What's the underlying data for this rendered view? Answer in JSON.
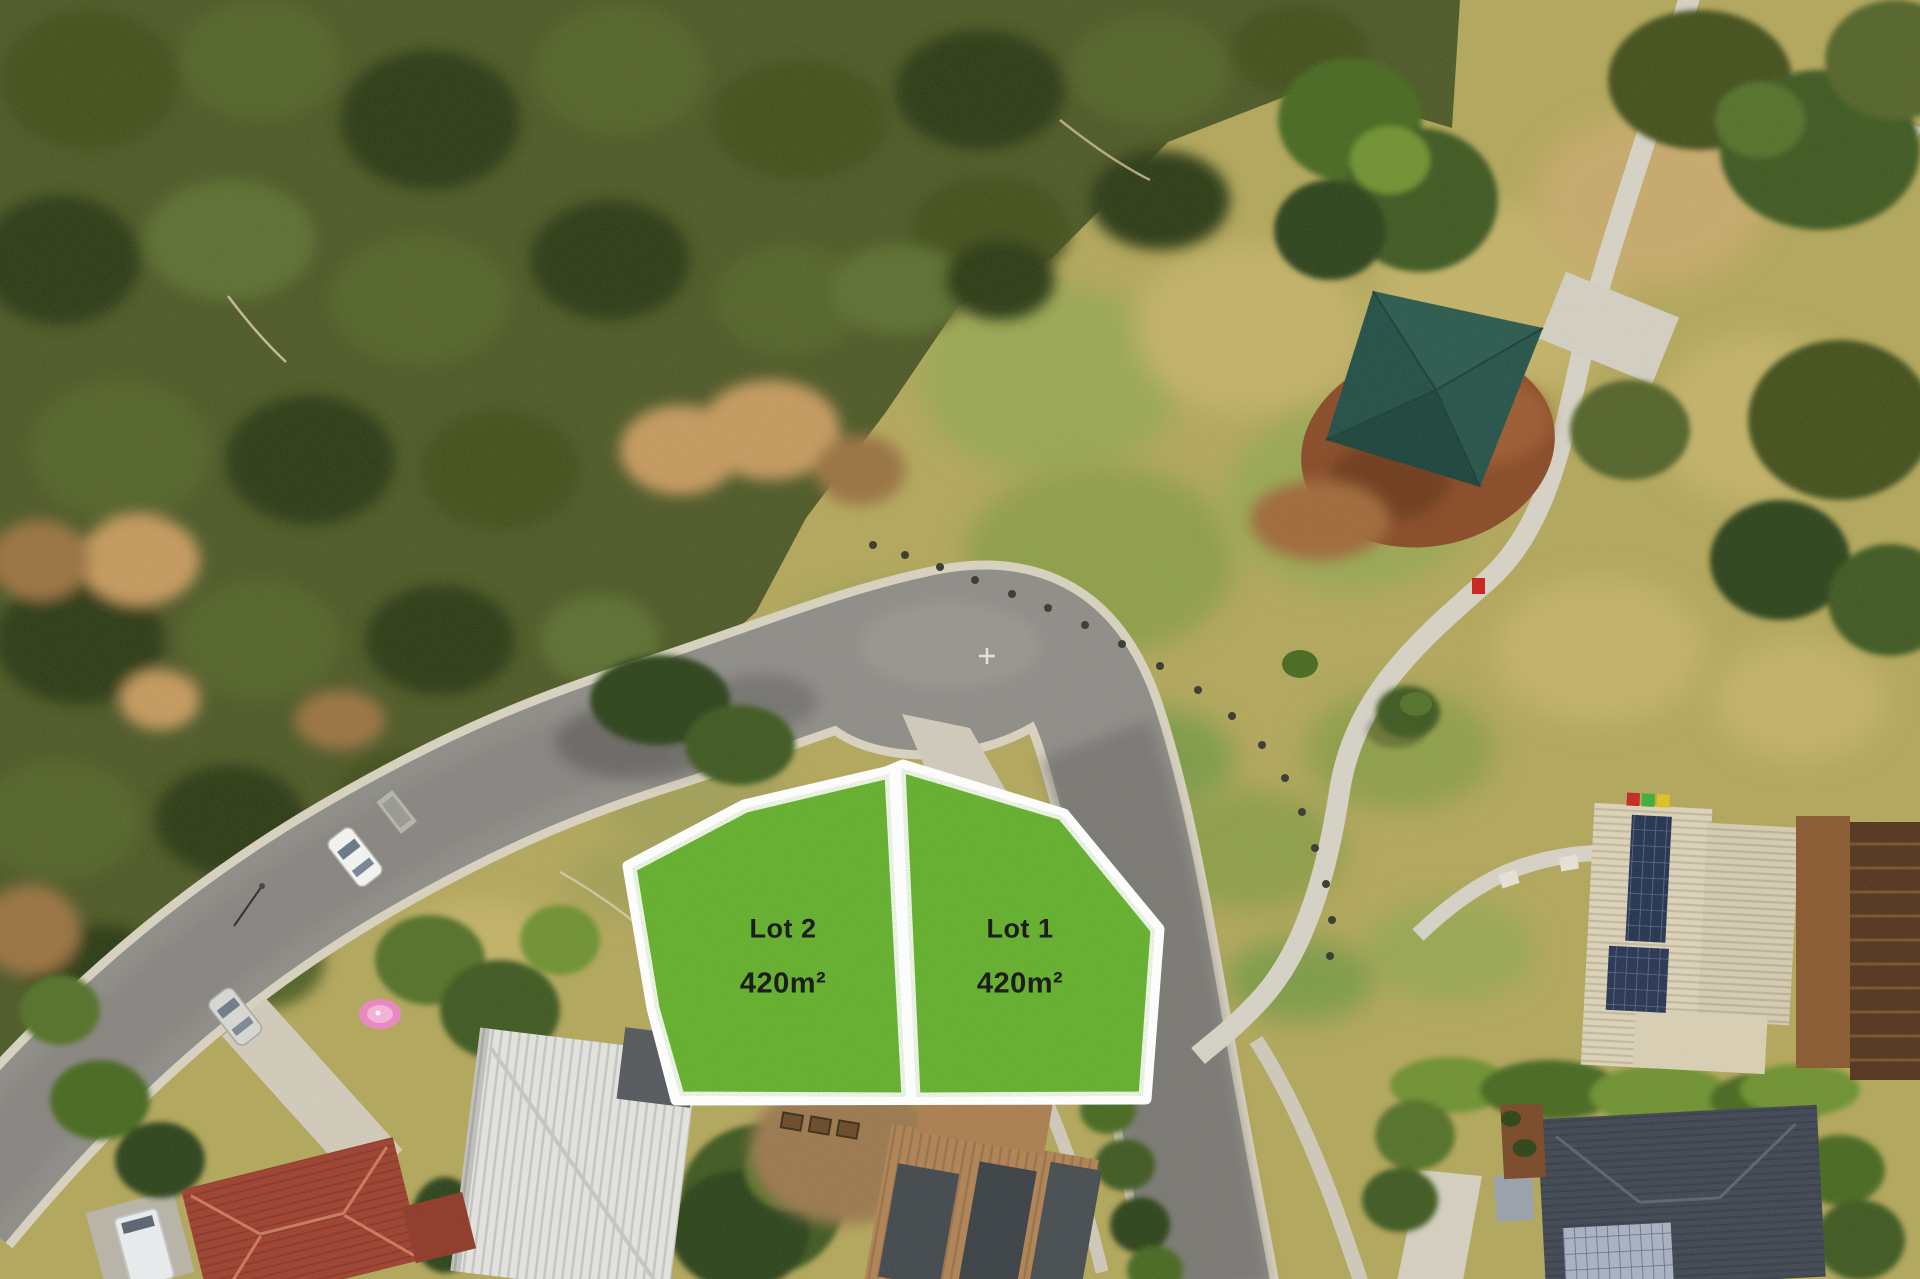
{
  "scene": {
    "type": "aerial-photo",
    "lot_overlay": {
      "lots": [
        {
          "name": "Lot 1",
          "area": "420m²"
        },
        {
          "name": "Lot 2",
          "area": "420m²"
        }
      ],
      "fill": "#63b02a",
      "border": "#ffffff",
      "text_color": "#1d1d1b"
    },
    "palette": {
      "park_grass": "#b3a75c",
      "bushland": "#4f5a28",
      "road_asphalt": "#8f8d88",
      "kerb_concrete": "#d8d2c0",
      "path_concrete": "#d6d2c6",
      "shade_sail": "#2a574a",
      "mulch": "#8a4c28",
      "roof_beige": "#ddd3b8",
      "roof_white": "#e3e3df",
      "roof_red": "#9e4130",
      "roof_dark": "#414854",
      "solar_panel": "#26344f"
    }
  }
}
